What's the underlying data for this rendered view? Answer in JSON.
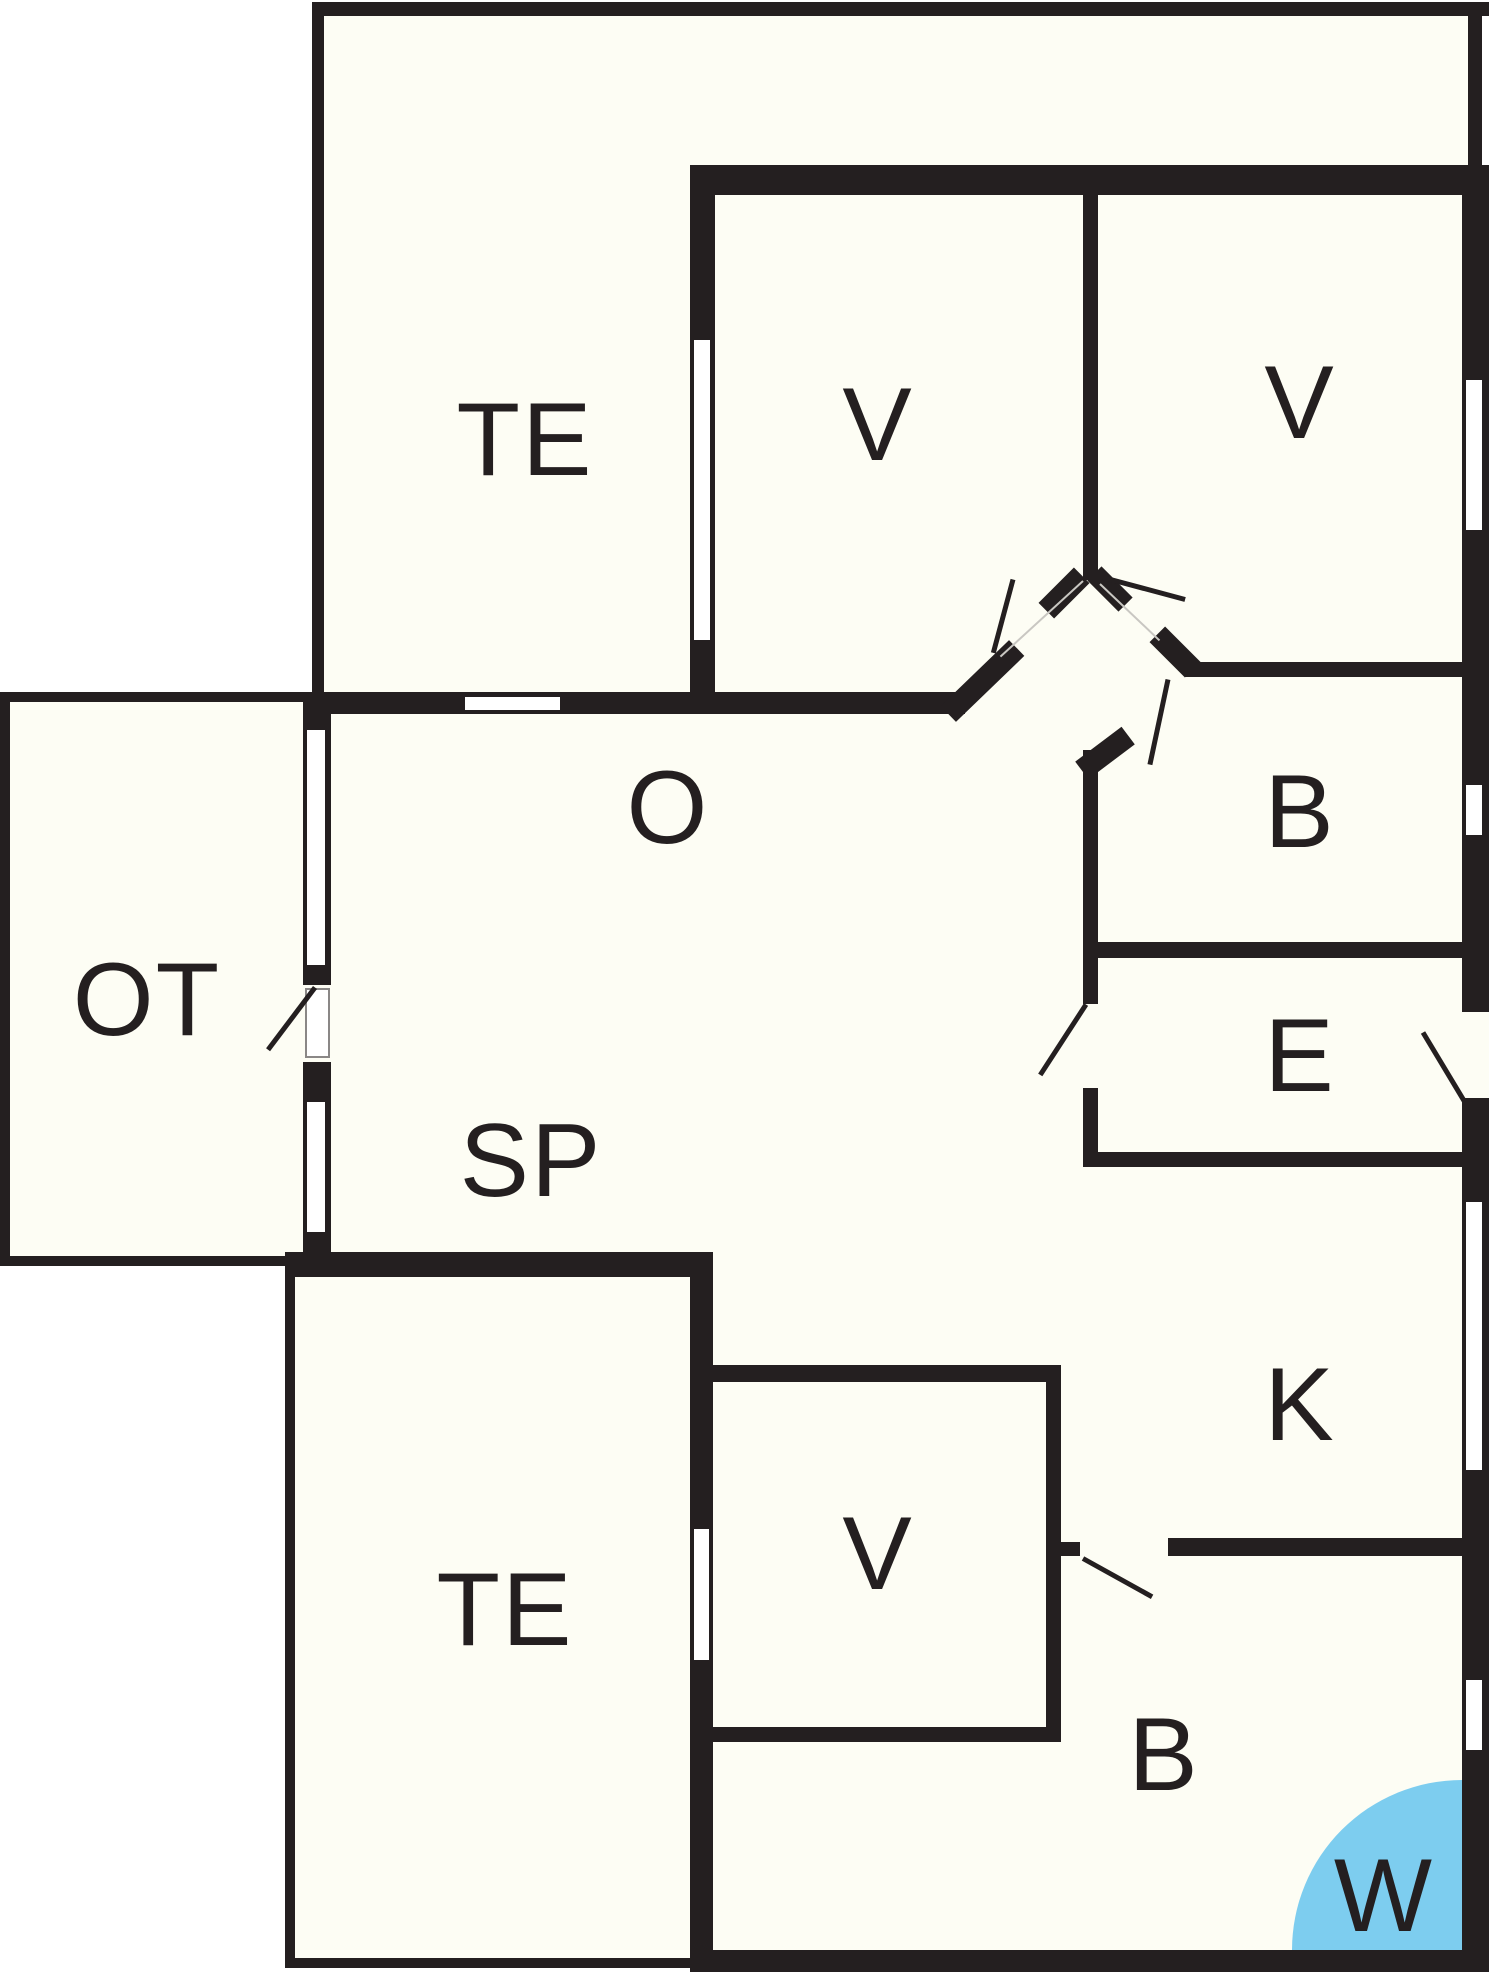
{
  "title": "Holiday home floor plan",
  "colors": {
    "wall": "#241F20",
    "floor": "#FDFDF4",
    "outside": "#FFFFFF",
    "water": "#7DCDEF"
  },
  "rooms": [
    {
      "id": "terrace-north",
      "label": "TE"
    },
    {
      "id": "bedroom-nw",
      "label": "V"
    },
    {
      "id": "bedroom-ne",
      "label": "V"
    },
    {
      "id": "livingroom",
      "label": "O"
    },
    {
      "id": "covered-terrace",
      "label": "OT"
    },
    {
      "id": "bathroom-north",
      "label": "B"
    },
    {
      "id": "entrance",
      "label": "E"
    },
    {
      "id": "dining",
      "label": "SP"
    },
    {
      "id": "kitchen",
      "label": "K"
    },
    {
      "id": "terrace-south",
      "label": "TE"
    },
    {
      "id": "bedroom-south",
      "label": "V"
    },
    {
      "id": "bathroom-south",
      "label": "B"
    },
    {
      "id": "whirlpool",
      "label": "W"
    }
  ]
}
